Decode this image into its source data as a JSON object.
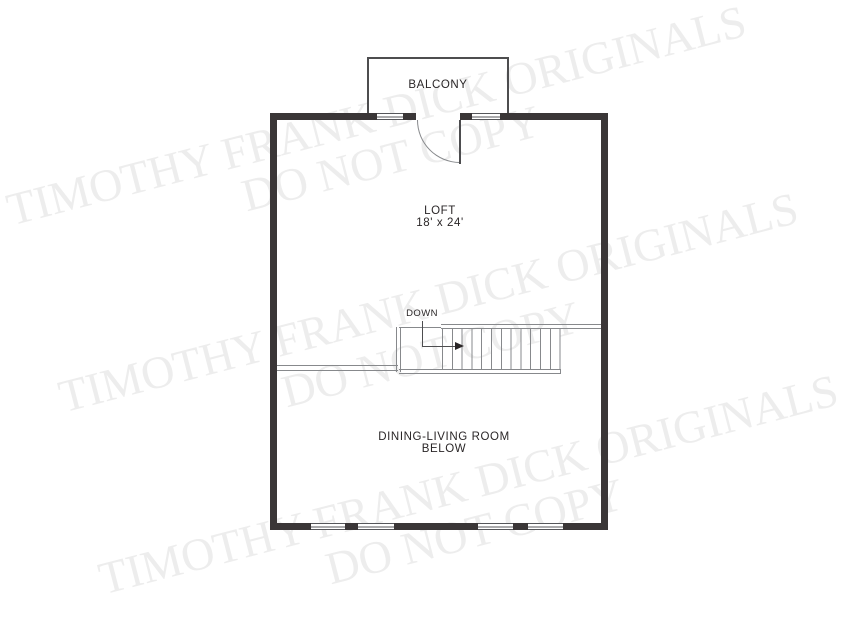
{
  "plan": {
    "balcony_label": "BALCONY",
    "loft": {
      "name": "LOFT",
      "dimensions": "18' x 24'"
    },
    "stairs": {
      "down_label": "DOWN",
      "tread_count": 13,
      "direction_icon": "right-arrow"
    },
    "room_below": {
      "line1": "DINING-LIVING ROOM",
      "line2": "BELOW"
    }
  },
  "watermark": {
    "line1": "TIMOTHY FRANK DICK ORIGINALS",
    "line2": "DO NOT COPY"
  },
  "colors": {
    "wall": "#3a3637",
    "line": "#87898c",
    "line_dark": "#4d4d4f",
    "win_line": "#55565a",
    "text": "#2a2627",
    "watermark": "#ededed",
    "background": "#ffffff"
  }
}
